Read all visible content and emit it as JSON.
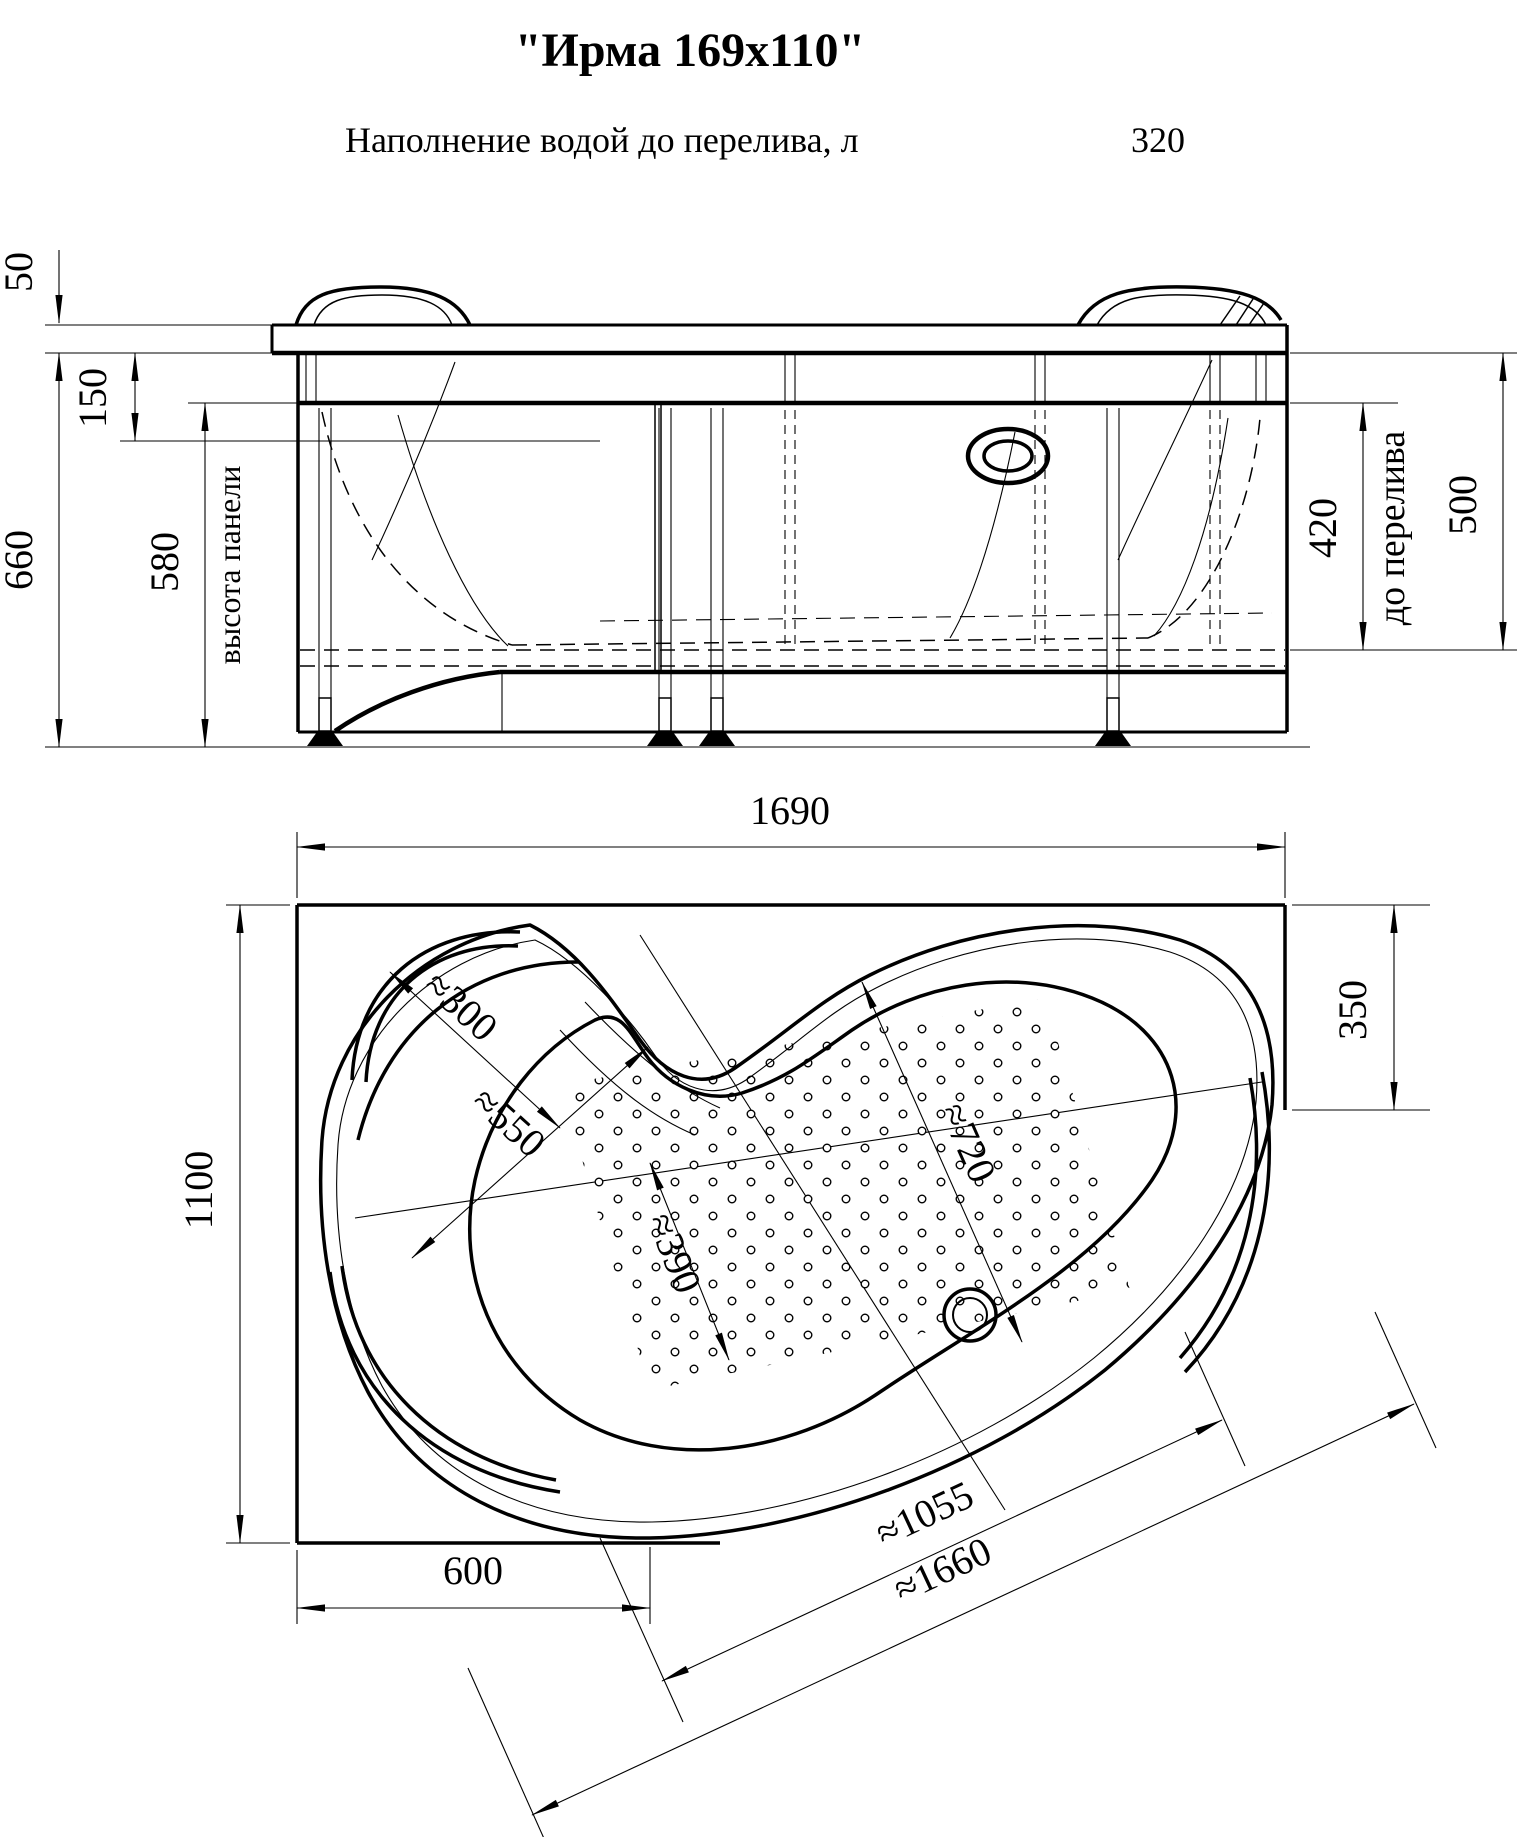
{
  "title": "\"Ирма 169x110\"",
  "subtitle": {
    "label": "Наполнение водой до перелива, л",
    "value": "320"
  },
  "front_view": {
    "dims": {
      "rim": "50",
      "top_offset": "150",
      "total_height": "660",
      "panel_height": "580",
      "panel_height_label": "высота панели",
      "to_overflow": "420",
      "to_overflow_label": "до перелива",
      "rim_to_overflow": "500"
    }
  },
  "plan_view": {
    "dims": {
      "length": "1690",
      "width": "1100",
      "right_side": "350",
      "bottom_left": "600",
      "seat_depth": "≈300",
      "seat_width": "≈550",
      "bottom_width": "≈390",
      "bottom_length": "≈720",
      "inner_length": "≈1055",
      "total_diagonal": "≈1660"
    }
  }
}
